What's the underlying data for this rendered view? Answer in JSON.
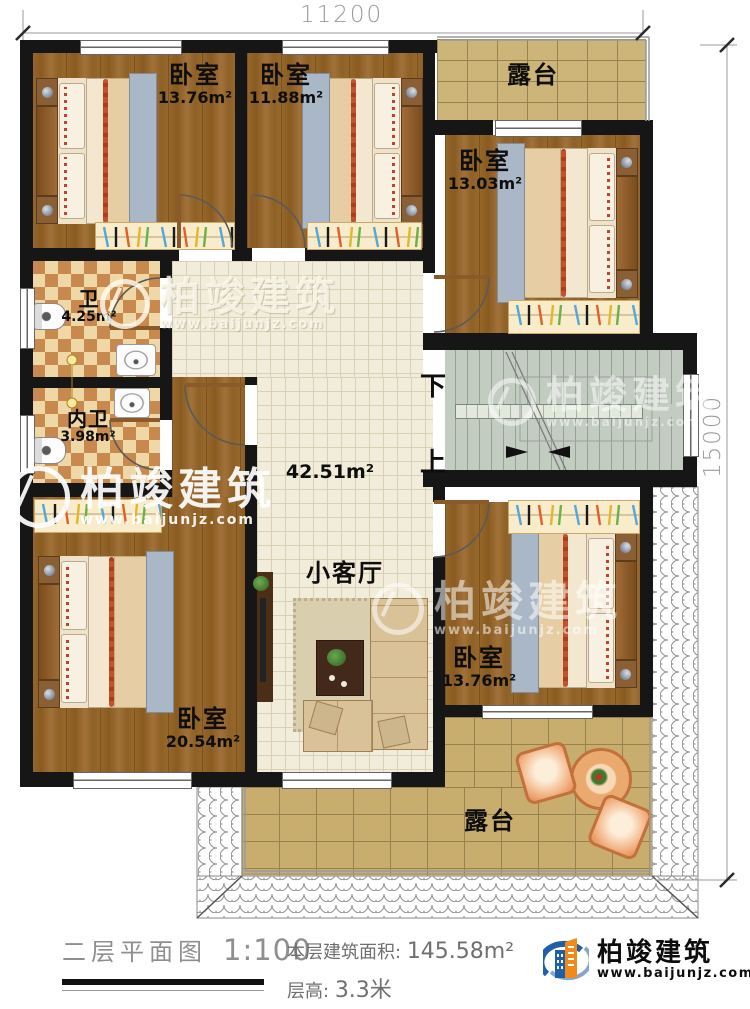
{
  "dimensions": {
    "top": "11200",
    "right": "15000"
  },
  "rooms": {
    "bedroom_top_left": {
      "name": "卧室",
      "area": "13.76m²"
    },
    "bedroom_top_middle": {
      "name": "卧室",
      "area": "11.88m²"
    },
    "bedroom_top_right": {
      "name": "卧室",
      "area": "13.03m²"
    },
    "bathroom": {
      "name": "卫",
      "area": "4.25m²"
    },
    "bathroom_inner": {
      "name": "内卫",
      "area": "3.98m²"
    },
    "hall": {
      "area": "42.51m²"
    },
    "living_room": {
      "name": "小客厅"
    },
    "bedroom_bottom_left": {
      "name": "卧室",
      "area": "20.54m²"
    },
    "bedroom_bottom_right": {
      "name": "卧室",
      "area": "13.76m²"
    },
    "terrace_top": {
      "name": "露台"
    },
    "terrace_bottom": {
      "name": "露台"
    }
  },
  "stairs": {
    "down_label": "下",
    "up_label": "上"
  },
  "watermark": {
    "name": "柏竣建筑",
    "website": "www.baijunjz.com"
  },
  "footer": {
    "plan_title": "二层平面图",
    "scale": "1:100",
    "floor_area_label": "本层建筑面积:",
    "floor_area_value": "145.58m²",
    "floor_height_label": "层高:",
    "floor_height_value": "3.3米"
  },
  "brand": {
    "name": "柏竣建筑",
    "website": "www.baijunjz.com"
  },
  "colors": {
    "wall": "#161616",
    "wood_floor": "#8f6226",
    "tile_floor": "#f2ecda",
    "paving": "#cdb478",
    "stair": "#c2ccc0",
    "checker_light": "#efd7a6",
    "checker_dark": "#c8894e",
    "accent_blue": "#1e5fa8",
    "accent_orange": "#f08a1d"
  }
}
